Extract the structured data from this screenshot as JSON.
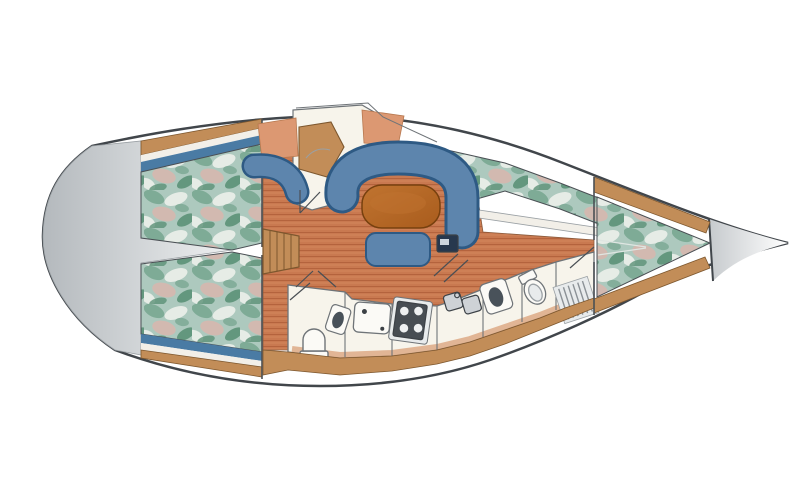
{
  "figure": {
    "kind": "sailboat-interior-floor-plan",
    "orientation": "bow-right"
  },
  "palette": {
    "hull_stroke": "#41464b",
    "hull_fill": "#ffffff",
    "stern_dark": "#b4b9bd",
    "stern_light": "#eef0f1",
    "bow_dark": "#c6cacd",
    "bow_light": "#ffffff",
    "floor_base": "#c97950",
    "floor_line": "#b2603a",
    "floor_line_light": "#d98f63",
    "floor_edge": "#8a5a3c",
    "wood_fill": "#c28d58",
    "wood_stroke": "#7d572e",
    "blue_stripe": "#4a7ba4",
    "teal_base": "#adc9be",
    "teal_dark": "#79a892",
    "teal_deep": "#5b9177",
    "teal_pink": "#d8b6ae",
    "teal_white": "#edf0ea",
    "settee_fill": "#5d85ad",
    "settee_dark": "#2e5a84",
    "table_fill": "#a95c1d",
    "table_stroke": "#77400e",
    "table_hi": "#c07430",
    "salmon": "#dc9872",
    "salmon_stroke": "#b7784f",
    "salmon_front": "#d9a078",
    "room_fill": "#f7f4eb",
    "room_white": "#fbfaf6",
    "room_stroke": "#6f7478",
    "white_strip": "#f2efe8",
    "appliance_dark": "#474d53",
    "appliance_mid": "#ced2d6",
    "appliance_stroke": "#3c4146",
    "basin_dark": "#49525a",
    "burner": "#eef0f1",
    "grate_bg": "#e8ebec",
    "grate_line": "#8b9196",
    "pedestal": "#27384e",
    "pedestal_hi": "#cdd6df",
    "line_thin": "#4a4f54",
    "seam_light": "#dfe6e2",
    "edge_soft": "#9aa0a4"
  },
  "features": {
    "hull": "yacht hull outline",
    "stern_locker": "stern lazarette area",
    "aft_berths": "port and starboard aft cabin double berths",
    "companionway": "companionway steps",
    "salon_floor": "teak cabin sole",
    "nav_station": "navigation station with chart table",
    "u_settee": "U-shaped salon settee",
    "salon_table": "oval salon table",
    "stool": "salon bench stool",
    "galley": "galley with sink and stove",
    "heads": "aft head and forward head with shower",
    "v_berth": "forward cabin V-berth",
    "anchor_locker": "bow anchor locker"
  }
}
